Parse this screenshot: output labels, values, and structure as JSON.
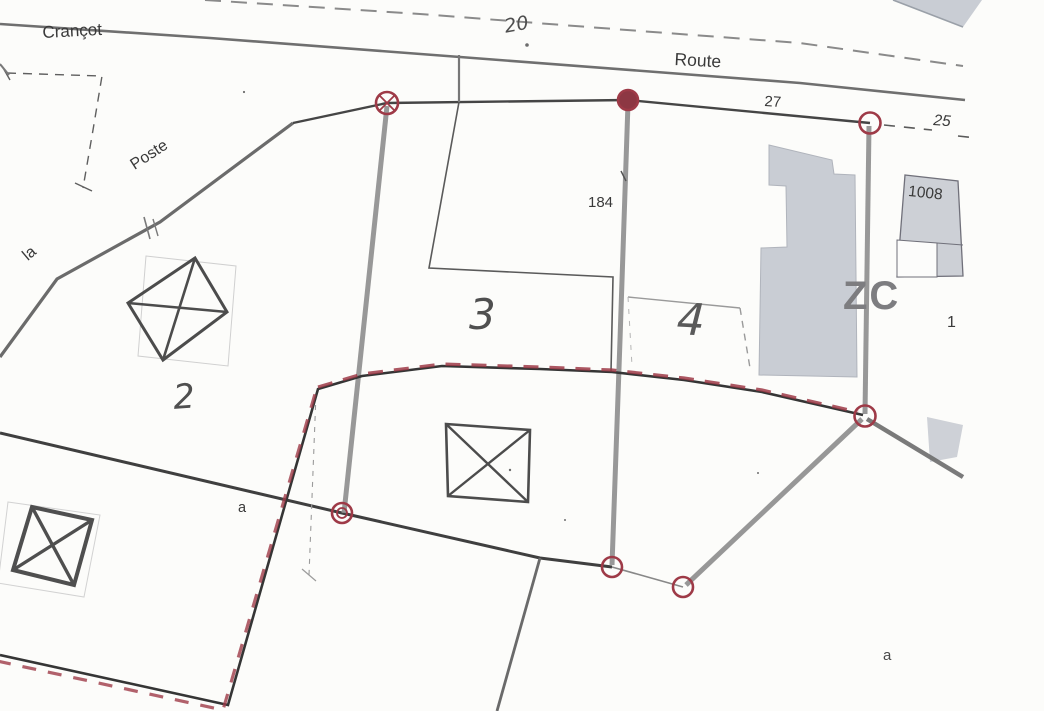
{
  "map": {
    "labels": {
      "crancot": "Crançot",
      "route": "Route",
      "la": "la",
      "poste": "Poste",
      "n20": "20",
      "n27": "27",
      "n25": "25",
      "n184": "184",
      "n1008": "1008",
      "zc": "ZC",
      "n1": "1",
      "parcel2": "2",
      "parcel3": "3",
      "parcel4": "4",
      "a_left": "a",
      "a_right": "a"
    },
    "colors": {
      "boundary_dark": "#3f3f3f",
      "road_gray": "#6f6f6f",
      "wall_gray": "#8f8f8f",
      "red_marker": "#9e3a47",
      "building_fill": "#c9cdd4",
      "paper": "#fcfcfa",
      "ink_text": "#3a3a3a"
    }
  }
}
